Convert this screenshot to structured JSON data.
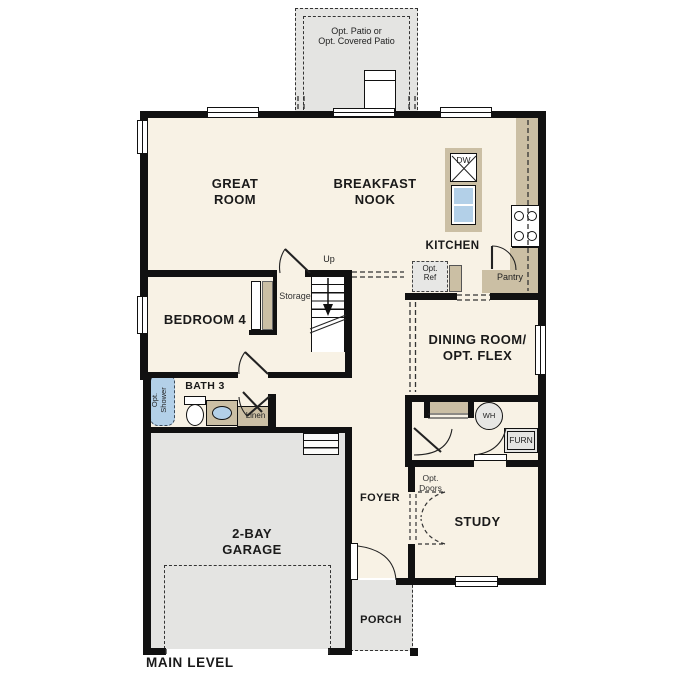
{
  "plan_title": "MAIN LEVEL",
  "rooms": {
    "patio": {
      "label": "Opt. Patio or\nOpt. Covered Patio"
    },
    "great_room": {
      "label": "GREAT\nROOM"
    },
    "breakfast_nook": {
      "label": "BREAKFAST\nNOOK"
    },
    "kitchen": {
      "label": "KITCHEN"
    },
    "bedroom_4": {
      "label": "BEDROOM 4"
    },
    "bath_3": {
      "label": "BATH 3"
    },
    "dining_room": {
      "label": "DINING ROOM/\nOPT. FLEX"
    },
    "foyer": {
      "label": "FOYER"
    },
    "study": {
      "label": "STUDY"
    },
    "garage": {
      "label": "2-BAY\nGARAGE"
    },
    "porch": {
      "label": "PORCH"
    }
  },
  "features": {
    "up": "Up",
    "storage": "Storage",
    "linen": "Linen",
    "pantry": "Pantry",
    "dishwasher": "DW",
    "opt_ref": "Opt.\nRef",
    "opt_shower": "Opt.\nShower",
    "opt_doors": "Opt.\nDoors",
    "water_heater": "WH",
    "furnace": "FURN"
  },
  "colors": {
    "wall": "#111111",
    "floor": "#f8f2e5",
    "hardscape": "#e4e4e2",
    "cabinet_tan": "#cbbfa4",
    "fixture_blue": "#b3d0e8",
    "line": "#222222"
  }
}
